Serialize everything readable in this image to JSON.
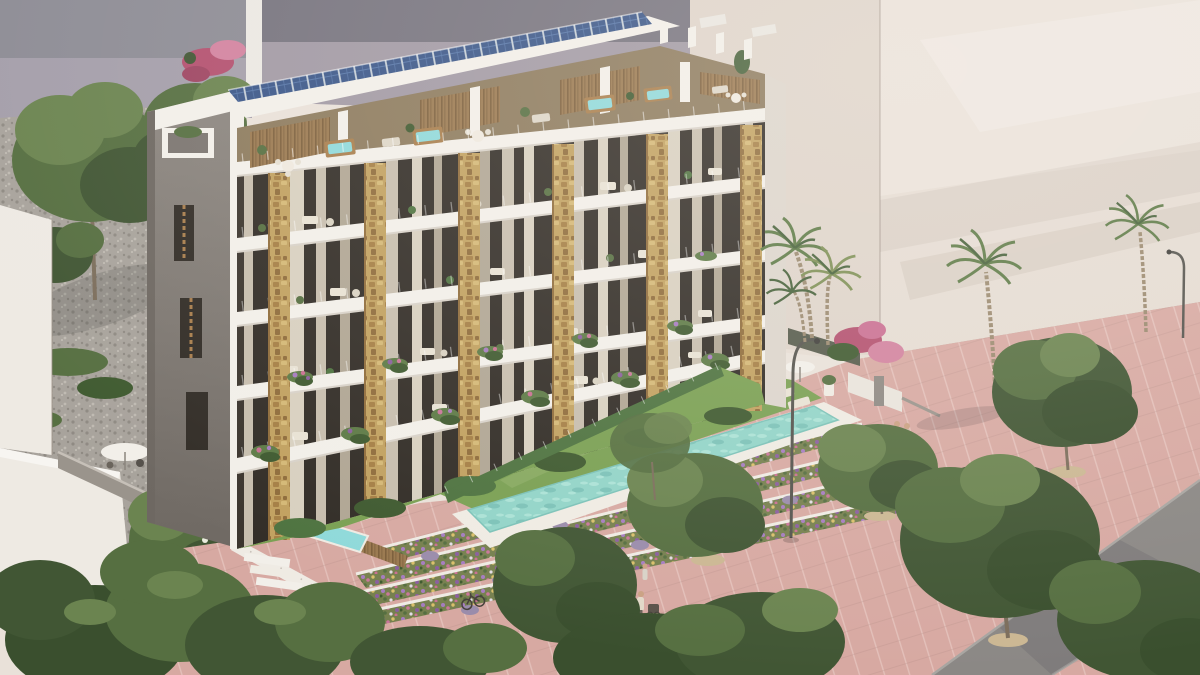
{
  "scene": {
    "type": "architectural_exterior_render",
    "description": "Aerial three-quarter view render of a modern 6-level Mediterranean apartment building with rooftop solar panels, penthouse terraces with hot tubs, white balcony slabs separated by golden stone-clad pillars, hanging planters, private ground-floor gardens behind a glass-and-hedge fence, a turquoise lap pool with a swimmer, terraced flower beds, a pink paved promenade with street trees, palm trees, pedestrians and parked bicycles; pale neighboring buildings form the backdrop.",
    "no_visible_text": true,
    "time_of_day": "sunny daytime",
    "objects": [
      "main-apartment-building",
      "solar-panel-array",
      "penthouse-terraces",
      "hot-tubs",
      "stone-pillars",
      "balconies-with-curtains",
      "hanging-planters",
      "gray-stair-tower",
      "ground-floor-gardens",
      "hedge-fence",
      "lap-pool",
      "swimmer",
      "lawn-with-umbrella-and-sunbeds",
      "plunge-pool-terrace",
      "terraced-flower-beds",
      "white-retaining-wall-with-stairs",
      "pink-promenade",
      "gray-road",
      "street-trees",
      "palm-trees",
      "street-lamps",
      "pedestrians",
      "bicycles",
      "scooter",
      "backdrop-gray-buildings",
      "backdrop-cream-wall",
      "neighbor-white-building",
      "gravel-yard",
      "bougainvillea"
    ]
  },
  "counts": {
    "residential_floors_visible": 5,
    "penthouse_hot_tubs": 4,
    "stone_pillars": 6,
    "palm_trees": 4,
    "street_trees": 8,
    "pedestrians": 8,
    "bicycles": 3,
    "street_lamps": 2,
    "parasols": 4,
    "sunbeds": 4
  },
  "colors": {
    "bg": "#e9e1d9",
    "backdrop_gray_dark": "#8d8c95",
    "backdrop_gray_light": "#a49eaa",
    "backdrop_sliver": "#ebe8e3",
    "backdrop_mid_dark": "#76737e",
    "backdrop_mid_band": "#a199a4",
    "cream_wall": "#e5dcd3",
    "cream_wall_near": "#ded4ca",
    "cream_wall_top": "#eae2da",
    "gravel_base": "#a8a39c",
    "gravel_dot_dark": "#8f8a83",
    "gravel_dot_light": "#bfbab2",
    "gravel_strip": "#b2a494",
    "white_building": "#eeeae3",
    "slab_white": "#f2efe9",
    "slab_shadow": "#d8d2c9",
    "tower_top": "#8d8781",
    "tower_bottom": "#6f6963",
    "tower_edge": "#6e6862",
    "window_dark": "#3b352e",
    "curtain_beige": "#c7beae",
    "curtain_cream": "#d8d0c0",
    "curtain_tan": "#b0a694",
    "glass_dark": "#322d27",
    "stone_base": "#c1a160",
    "stone_dark": "#a57f45",
    "stone_darker": "#8f6c3b",
    "stone_light": "#d4b876",
    "wood": "#9a7950",
    "wood_dark": "#7c5f3c",
    "penthouse_base": "#8d7b5e",
    "tub_water": "#8fd9da",
    "tub_wood": "#a87e4d",
    "solar_frame": "#c9d2da",
    "solar_cell": "#3a5688",
    "solar_line": "#5575a8",
    "lawn": "#7aa053",
    "lawn_dark": "#688c46",
    "hedge": "#4e7340",
    "hedge_dark": "#3f5a30",
    "pool_water": "#92d4c8",
    "pool_light": "#abe2d6",
    "pool_deep": "#7cc2b8",
    "deck_white": "#efebe3",
    "paving": "#d7a9a2",
    "paving_light": "#f6e2dc",
    "road": "#8b8885",
    "road_curb": "#a8a5a1",
    "terrace_wall": "#efebe4",
    "flower_base": "#76804f",
    "flower_purple": "#a67cc0",
    "flower_violet": "#8a5f9e",
    "flower_pink": "#c9769a",
    "flower_magenta": "#c96f92",
    "flower_yellow": "#d9c06a",
    "flower_white": "#e3dce6",
    "lavender": "#9a8cab",
    "bougainvillea": "#b3506f",
    "bougainvillea_light": "#d2829f",
    "tree_dark": "#415634",
    "tree_mid": "#566f41",
    "tree_light": "#6b8450",
    "tree_deep": "#3a4f2e",
    "trunk": "#7c6e5c",
    "palm_green": "#5d7a46",
    "palm_dark": "#46613a",
    "palm_trunk": "#9b8a70",
    "treewell": "#cbb793",
    "skin": "#caa183",
    "metal": "#55544e",
    "white_furniture": "#e8e2d4"
  }
}
